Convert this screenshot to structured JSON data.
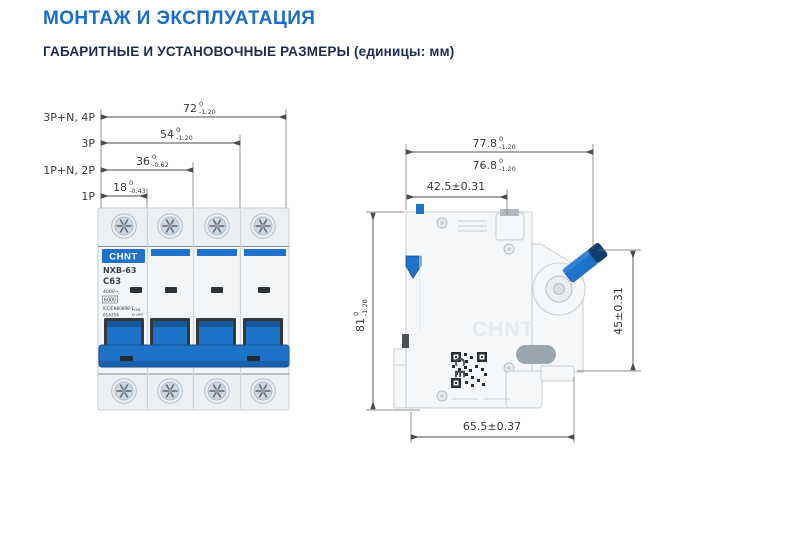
{
  "header": {
    "title": "МОНТАЖ И ЭКСПЛУАТАЦИЯ",
    "subtitle": "ГАБАРИТНЫЕ И УСТАНОВОЧНЫЕ РАЗМЕРЫ (единицы: мм)"
  },
  "colors": {
    "heading_blue": "#1a6ec6",
    "subheading_navy": "#1d2d50",
    "breaker_blue": "#1e72c8",
    "breaker_blue_dark": "#16508f",
    "dimension_line": "#4d4d4d"
  },
  "front_view": {
    "dimensions": [
      {
        "config": "3P+N, 4P",
        "value": "72",
        "upper": "0",
        "lower": "-1.20"
      },
      {
        "config": "3P",
        "value": "54",
        "upper": "0",
        "lower": "-1.20"
      },
      {
        "config": "1P+N, 2P",
        "value": "36",
        "upper": "0",
        "lower": "-0.62"
      },
      {
        "config": "1P",
        "value": "18",
        "upper": "0",
        "lower": "-0.43"
      }
    ],
    "breaker": {
      "brand": "CHNT",
      "model": "NXB-63",
      "rating": "C63",
      "voltage": "400V~",
      "capacity": "6000",
      "standard": "IEC/EN60898-1",
      "code": "61A254",
      "on_label": "I ON",
      "off_label": "O OFF"
    }
  },
  "side_view": {
    "dimensions": {
      "overall_width": {
        "value": "77.8",
        "upper": "0",
        "lower": "-1.20"
      },
      "body_width": {
        "value": "76.8",
        "upper": "0",
        "lower": "-1.20"
      },
      "din_offset": {
        "value": "42.5±0.31"
      },
      "height": {
        "value": "81",
        "upper": "0",
        "lower": "-1.20"
      },
      "front_height": {
        "value": "45±0.31"
      },
      "base_width": {
        "value": "65.5±0.37"
      }
    },
    "watermark": "CHNT",
    "ce_mark": "CE"
  }
}
